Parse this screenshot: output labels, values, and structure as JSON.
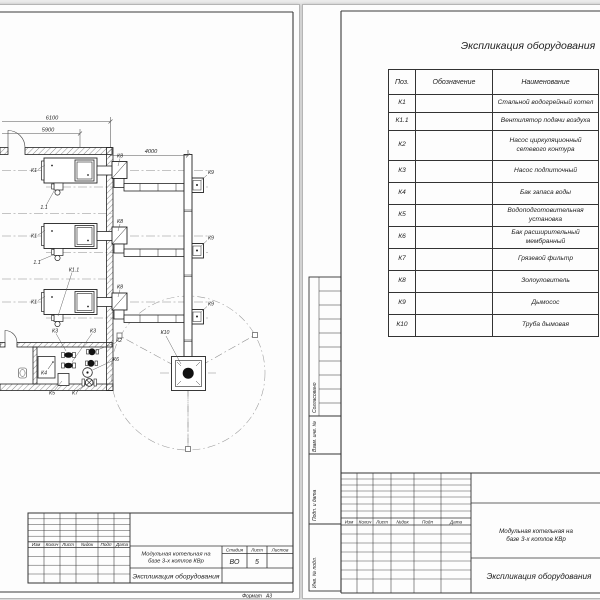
{
  "stamp_columns": [
    "Изм",
    "Колич",
    "Лист",
    "№док",
    "Подп",
    "Дата"
  ],
  "project": {
    "name_line1": "Модульная котельная на",
    "name_line2": "базе 3-х котлов КВр",
    "doc_title": "Экспликация оборудования"
  },
  "left_sheet": {
    "dimensions": {
      "overall": "6100",
      "inner": "5900",
      "offset": "4000"
    },
    "labels": {
      "k1": "К1",
      "k1_1_short": "1.1",
      "k1_1": "К1.1",
      "k2": "К2",
      "k3": "К3",
      "k4": "К4",
      "k5": "К5",
      "k6": "К6",
      "k7": "К7",
      "k8": "К8",
      "k9": "К9",
      "k10": "К10"
    },
    "title_block": {
      "stage_label": "Стадия",
      "sheet_label": "Лист",
      "sheets_label": "Листов",
      "stage_value": "ВО",
      "sheet_value": "5",
      "format_label": "Формат",
      "format_value": "А3"
    }
  },
  "right_sheet": {
    "table_title": "Экспликация оборудования",
    "table": {
      "columns": [
        "Поз.",
        "Обозначение",
        "Наименование"
      ],
      "rows": [
        {
          "pos": "К1",
          "designation": "",
          "name": "Стальной водогрейный котел"
        },
        {
          "pos": "К1.1",
          "designation": "",
          "name": "Вентилятор подачи воздуха"
        },
        {
          "pos": "К2",
          "designation": "",
          "name": "Насос циркуляционный сетевого контура"
        },
        {
          "pos": "К3",
          "designation": "",
          "name": "Насос подпиточный"
        },
        {
          "pos": "К4",
          "designation": "",
          "name": "Бак запаса воды"
        },
        {
          "pos": "К5",
          "designation": "",
          "name": "Водоподготовительная установка"
        },
        {
          "pos": "К6",
          "designation": "",
          "name": "Бак расширительный мембранный"
        },
        {
          "pos": "К7",
          "designation": "",
          "name": "Грязевой фильтр"
        },
        {
          "pos": "К8",
          "designation": "",
          "name": "Золоуловитель"
        },
        {
          "pos": "К9",
          "designation": "",
          "name": "Дымосос"
        },
        {
          "pos": "К10",
          "designation": "",
          "name": "Труба дымовая"
        }
      ]
    },
    "side_stamp": {
      "agreed": "Согласовано",
      "inv_ref": "Взам. инв. №",
      "sign_date": "Подп. и дата",
      "inv_orig": "Инв. № подл."
    }
  }
}
